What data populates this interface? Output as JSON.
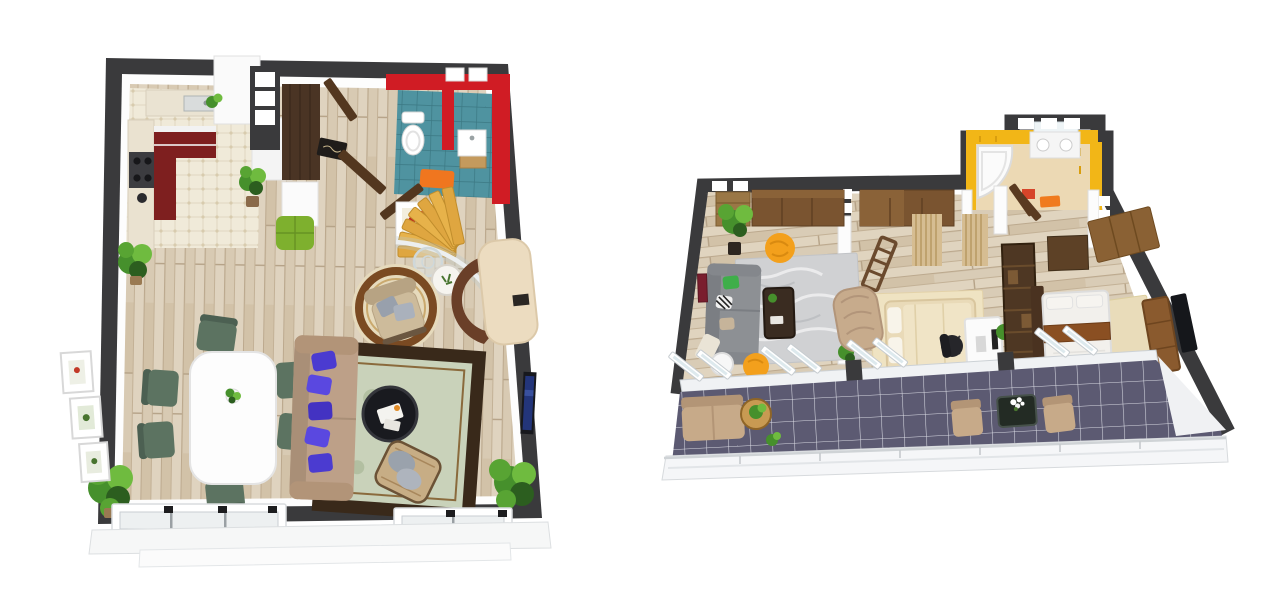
{
  "page": {
    "background": "#ffffff",
    "content_type": "two 3D-rendered apartment floor plans, top-down view, side by side on white"
  },
  "palette": {
    "wall_dark": "#3a3a3c",
    "floor_wood": "#d8cab3",
    "kitchen_tile": "#f0ead9",
    "cabinet_maroon": "#7e1f1f",
    "bath_red": "#d01c24",
    "bath_teal": "#4f93a0",
    "accent_orange": "#f0761f",
    "bath_yellow": "#f2b617",
    "bath_floor": "#ecd9b4",
    "balcony_tile": "#5c5a72",
    "sofa_beige": "#bda088",
    "pillow_violet": "#4b3bd0",
    "chair_green": "#5c7361",
    "ottoman_green": "#7eb02e",
    "rug_sage": "#c9d2ba",
    "rug_border": "#39291a",
    "rug_cream": "#e6dabc",
    "wood_dark": "#4a3424",
    "wood_mid": "#7a5430",
    "wood_gold": "#dfa640",
    "sofa_gray": "#8d9094",
    "pouf_yellow": "#f3a01c",
    "marble_rug": "#d0d1d3",
    "bed_cream": "#e9dab8",
    "bed_white": "#f2f0ec",
    "bed_runner": "#8a4f22",
    "plant_green": "#46902c",
    "tan_furniture": "#c7aa89"
  },
  "floorplans": [
    {
      "id": "left-floorplan",
      "layout": "square open-plan level with dark charcoal walls, light wood plank floor",
      "rooms": [
        "kitchen (white tile floor, maroon cabinets, stove, sink, fridge)",
        "entry hall (dark walnut wardrobe, two open doors, black doormat, lime ottoman)",
        "bathroom (red walls, teal tile floor, toilet, wood-base sink, orange mat)",
        "stair area (golden wood steps, curved glass railing)",
        "open living-dining room"
      ],
      "furniture": [
        "white dining table with plant centerpiece",
        "six green dining chairs",
        "beige sofa with violet pillows",
        "black round coffee table",
        "sage-and-brown ornate area rug",
        "wicker lounge chair with gray pillows",
        "round cream rug with beige armchair",
        "white pedestal table with flowers",
        "glass side table",
        "curved cream bar cabinet with brown arc rug",
        "wall TV",
        "framed flower artwork",
        "three wall frames",
        "five green potted plants",
        "bottom window wall with sliding panes"
      ]
    },
    {
      "id": "right-floorplan",
      "layout": "wide apartment with perspective-slanted charcoal walls and full-width balcony",
      "rooms": [
        "living room (gray sofa, marble rug, yellow bean chair and pouf, wood wardrobe, tree plant)",
        "bedroom one (cream platform bed, tan armchair, curtains, desk with office chair)",
        "bedroom two (white bed with brown runner, dark headboard, TV cabinet, wardrobe)",
        "yellow bathroom (corner tub, vanity with mirror, orange mats)",
        "corridor with dark wood doors",
        "balcony (slate-purple tiles, white railing, tan bench and chairs, wood table, dark flower table)"
      ],
      "furniture": [
        "gray sofa with zebra/green/tan cushions",
        "dark wood coffee table",
        "marble-gray rug",
        "yellow bean chair",
        "yellow pouf",
        "white side table",
        "wood wardrobes",
        "pleated tan curtains",
        "ladder shelf",
        "cream double bed",
        "tan armchair",
        "white desk with black office chair",
        "dark shelving divider",
        "white double bed with brown runner",
        "TV sideboard and TV",
        "corner bathtub",
        "double vanity with mirror",
        "balcony bench, two chairs, round wood table with plant, dark marble table with white flowers"
      ]
    }
  ]
}
